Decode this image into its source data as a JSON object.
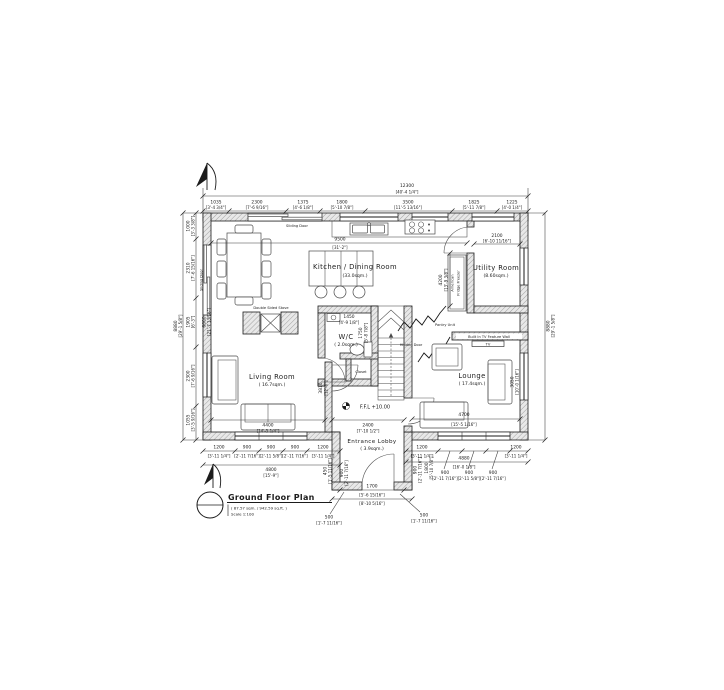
{
  "title_block": {
    "title": "Ground Floor Plan",
    "area": "( 87.57 sqm. / 942.59 sq.ft. )",
    "scale": "Scale 1:100"
  },
  "rooms": {
    "kitchen_dining": {
      "name": "Kitchen / Dining Room",
      "area": "(33.0sqm.)"
    },
    "utility": {
      "name": "Utility Room",
      "area": "(8.60sqm.)"
    },
    "wc": {
      "name": "W/C",
      "area": "( 2.0sqm.)"
    },
    "closet": {
      "name": "Closet"
    },
    "living": {
      "name": "Living Room",
      "area": "( 16.7sqm.)"
    },
    "lounge": {
      "name": "Lounge",
      "area": "( 17.4sqm.)"
    },
    "lobby": {
      "name": "Entrance Lobby",
      "area": "( 3.9sqm.)"
    }
  },
  "labels": {
    "sliding_door_top": "Sliding Door",
    "sliding_door_left": "Sliding Door",
    "double_sided_stove": "Double Sided Stove",
    "pantry_unit": "Pantry Unit",
    "hidden_door": "Hidden Door",
    "tv_feature_wall": "Built In TV Feature Wall",
    "tv": "TV",
    "fridge_line1": "American",
    "fridge_line2": "Fridge Freezer",
    "ffl": "F.F.L  +10.00"
  },
  "dims": {
    "top_overall": {
      "mm": "12300",
      "ft": "[40'-4 1/4\"]"
    },
    "top": [
      {
        "mm": "1035",
        "ft": "[3'-4 3/4\"]"
      },
      {
        "mm": "2300",
        "ft": "[7'-6 9/16\"]"
      },
      {
        "mm": "1375",
        "ft": "[4'-6 1/8\"]"
      },
      {
        "mm": "1800",
        "ft": "[5'-10 7/8\"]"
      },
      {
        "mm": "3500",
        "ft": "[11'-5 13/16\"]"
      },
      {
        "mm": "1825",
        "ft": "[5'-11 7/8\"]"
      },
      {
        "mm": "1225",
        "ft": "[4'-0 1/4\"]"
      }
    ],
    "kitchen_width": {
      "mm": "9500",
      "ft": "[31'-2\"]"
    },
    "utility_width": {
      "mm": "2100",
      "ft": "[6'-10 11/16\"]"
    },
    "utility_height": {
      "mm": "4200",
      "ft": "[13'-9 3/8\"]"
    },
    "wc_width": {
      "mm": "1450",
      "ft": "[4'-9 1/8\"]"
    },
    "wc_height": {
      "mm": "1750",
      "ft": "[5'-8 7/8\"]"
    },
    "left_overall": {
      "mm": "8880",
      "ft": "[29'-1 5/8\"]"
    },
    "left_inner": {
      "mm": "6600",
      "ft": "[21'-7 13/16\"]"
    },
    "left": [
      {
        "mm": "1000",
        "ft": "[3'-3 3/8\"]"
      },
      {
        "mm": "2310",
        "ft": "[7'-6 15/16\"]"
      },
      {
        "mm": "1905",
        "ft": "[6'-3\"]"
      },
      {
        "mm": "2300",
        "ft": "[7'-6 9/16\"]"
      },
      {
        "mm": "1055",
        "ft": "[3'-5 9/16\"]"
      }
    ],
    "right_overall": {
      "mm": "8880",
      "ft": "[29'-1 5/8\"]"
    },
    "living_width": {
      "mm": "4400",
      "ft": "[14'-5 1/4\"]"
    },
    "living_height": {
      "mm": "3810",
      "ft": "[12'-6\"]"
    },
    "lobby_width": {
      "mm": "2400",
      "ft": "[7'-10 1/2\"]"
    },
    "lounge_width": {
      "mm": "4700",
      "ft": "[15'-5 1/16\"]"
    },
    "lounge_height": {
      "mm": "3050",
      "ft": "[10'-0 1/16\"]"
    },
    "bottom_left": [
      {
        "mm": "1200",
        "ft": "[3'-11 1/4\"]"
      },
      {
        "mm": "900",
        "ft": "[2'-11 7/16\"]"
      },
      {
        "mm": "900",
        "ft": "[2'-11 5/8\"]"
      },
      {
        "mm": "900",
        "ft": "[2'-11 7/16\"]"
      },
      {
        "mm": "1200",
        "ft": "[3'-11 1/4\"]"
      }
    ],
    "bottom_left_total": {
      "mm": "4800",
      "ft": "[15'-9\"]"
    },
    "bottom_right": [
      {
        "mm": "1200",
        "ft": "[3'-11 1/4\"]"
      },
      {
        "mm": "900",
        "ft": "[2'-11 7/16\"]"
      },
      {
        "mm": "900",
        "ft": "[2'-11 5/8\"]"
      },
      {
        "mm": "900",
        "ft": "[2'-11 7/16\"]"
      },
      {
        "mm": "1200",
        "ft": "[3'-11 1/4\"]"
      }
    ],
    "bottom_right_total": {
      "mm": "4880",
      "ft": "[16'-0 1/8\"]"
    },
    "porch_width": {
      "mm": "1700",
      "ft": "[5'-6 15/16\"]"
    },
    "porch_total_ft": "[8'-10 5/16\"]",
    "porch_left_a": {
      "mm": "450",
      "ft": "[1'-5 11/16\"]"
    },
    "porch_left_b": {
      "mm": "900",
      "ft": "[2'-11 7/16\"]"
    },
    "porch_right_a": {
      "mm": "900",
      "ft": "[2'-11 7/16\"]"
    },
    "porch_right_b": {
      "mm": "1800",
      "ft": "[5'-10 7/8\"]"
    },
    "leader_left": {
      "mm": "500",
      "ft": "[1'-7 11/16\"]"
    },
    "leader_right": {
      "mm": "500",
      "ft": "[1'-7 11/16\"]"
    }
  }
}
